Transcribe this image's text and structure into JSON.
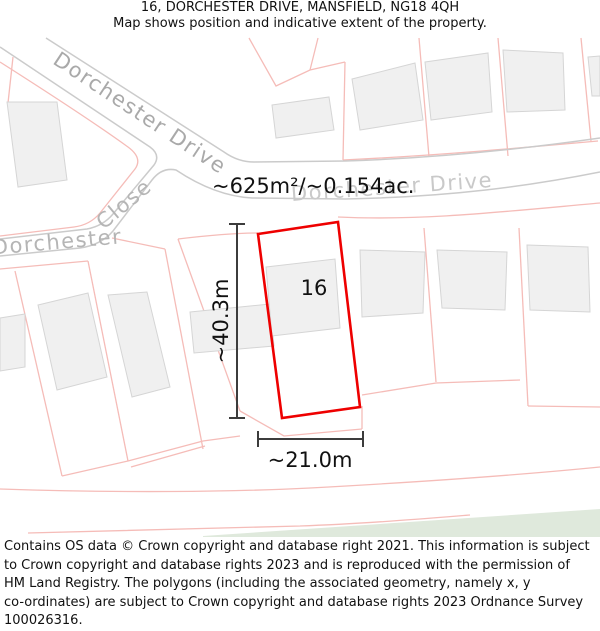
{
  "header": {
    "title": "16, DORCHESTER DRIVE, MANSFIELD, NG18 4QH",
    "subtitle": "Map shows position and indicative extent of the property."
  },
  "map": {
    "area_label": "~625m²/~0.154ac.",
    "plot_number": "16",
    "dim_vertical": "~40.3m",
    "dim_horizontal": "~21.0m",
    "road_labels": {
      "drive_diagonal": "Dorchester Drive",
      "drive_horizontal": "Dorchester Drive",
      "close_horizontal": "Dorchester",
      "close_diagonal": "Close"
    },
    "colors": {
      "plot_outline": "#ee0000",
      "parcel_line": "#f5bcb8",
      "road_edge": "#cbcbcb",
      "building_fill": "#f0f0f0",
      "building_stroke": "#d5d5d5",
      "greenspace": "#dfe9dc",
      "road_label": "#b4b4b4",
      "dimension_line": "#3c3c3c"
    }
  },
  "footer": {
    "lines": [
      "Contains OS data © Crown copyright and database right 2021. This information is subject",
      "to Crown copyright and database rights 2023 and is reproduced with the permission of",
      "HM Land Registry. The polygons (including the associated geometry, namely x, y",
      "co-ordinates) are subject to Crown copyright and database rights 2023 Ordnance Survey",
      "100026316."
    ]
  }
}
